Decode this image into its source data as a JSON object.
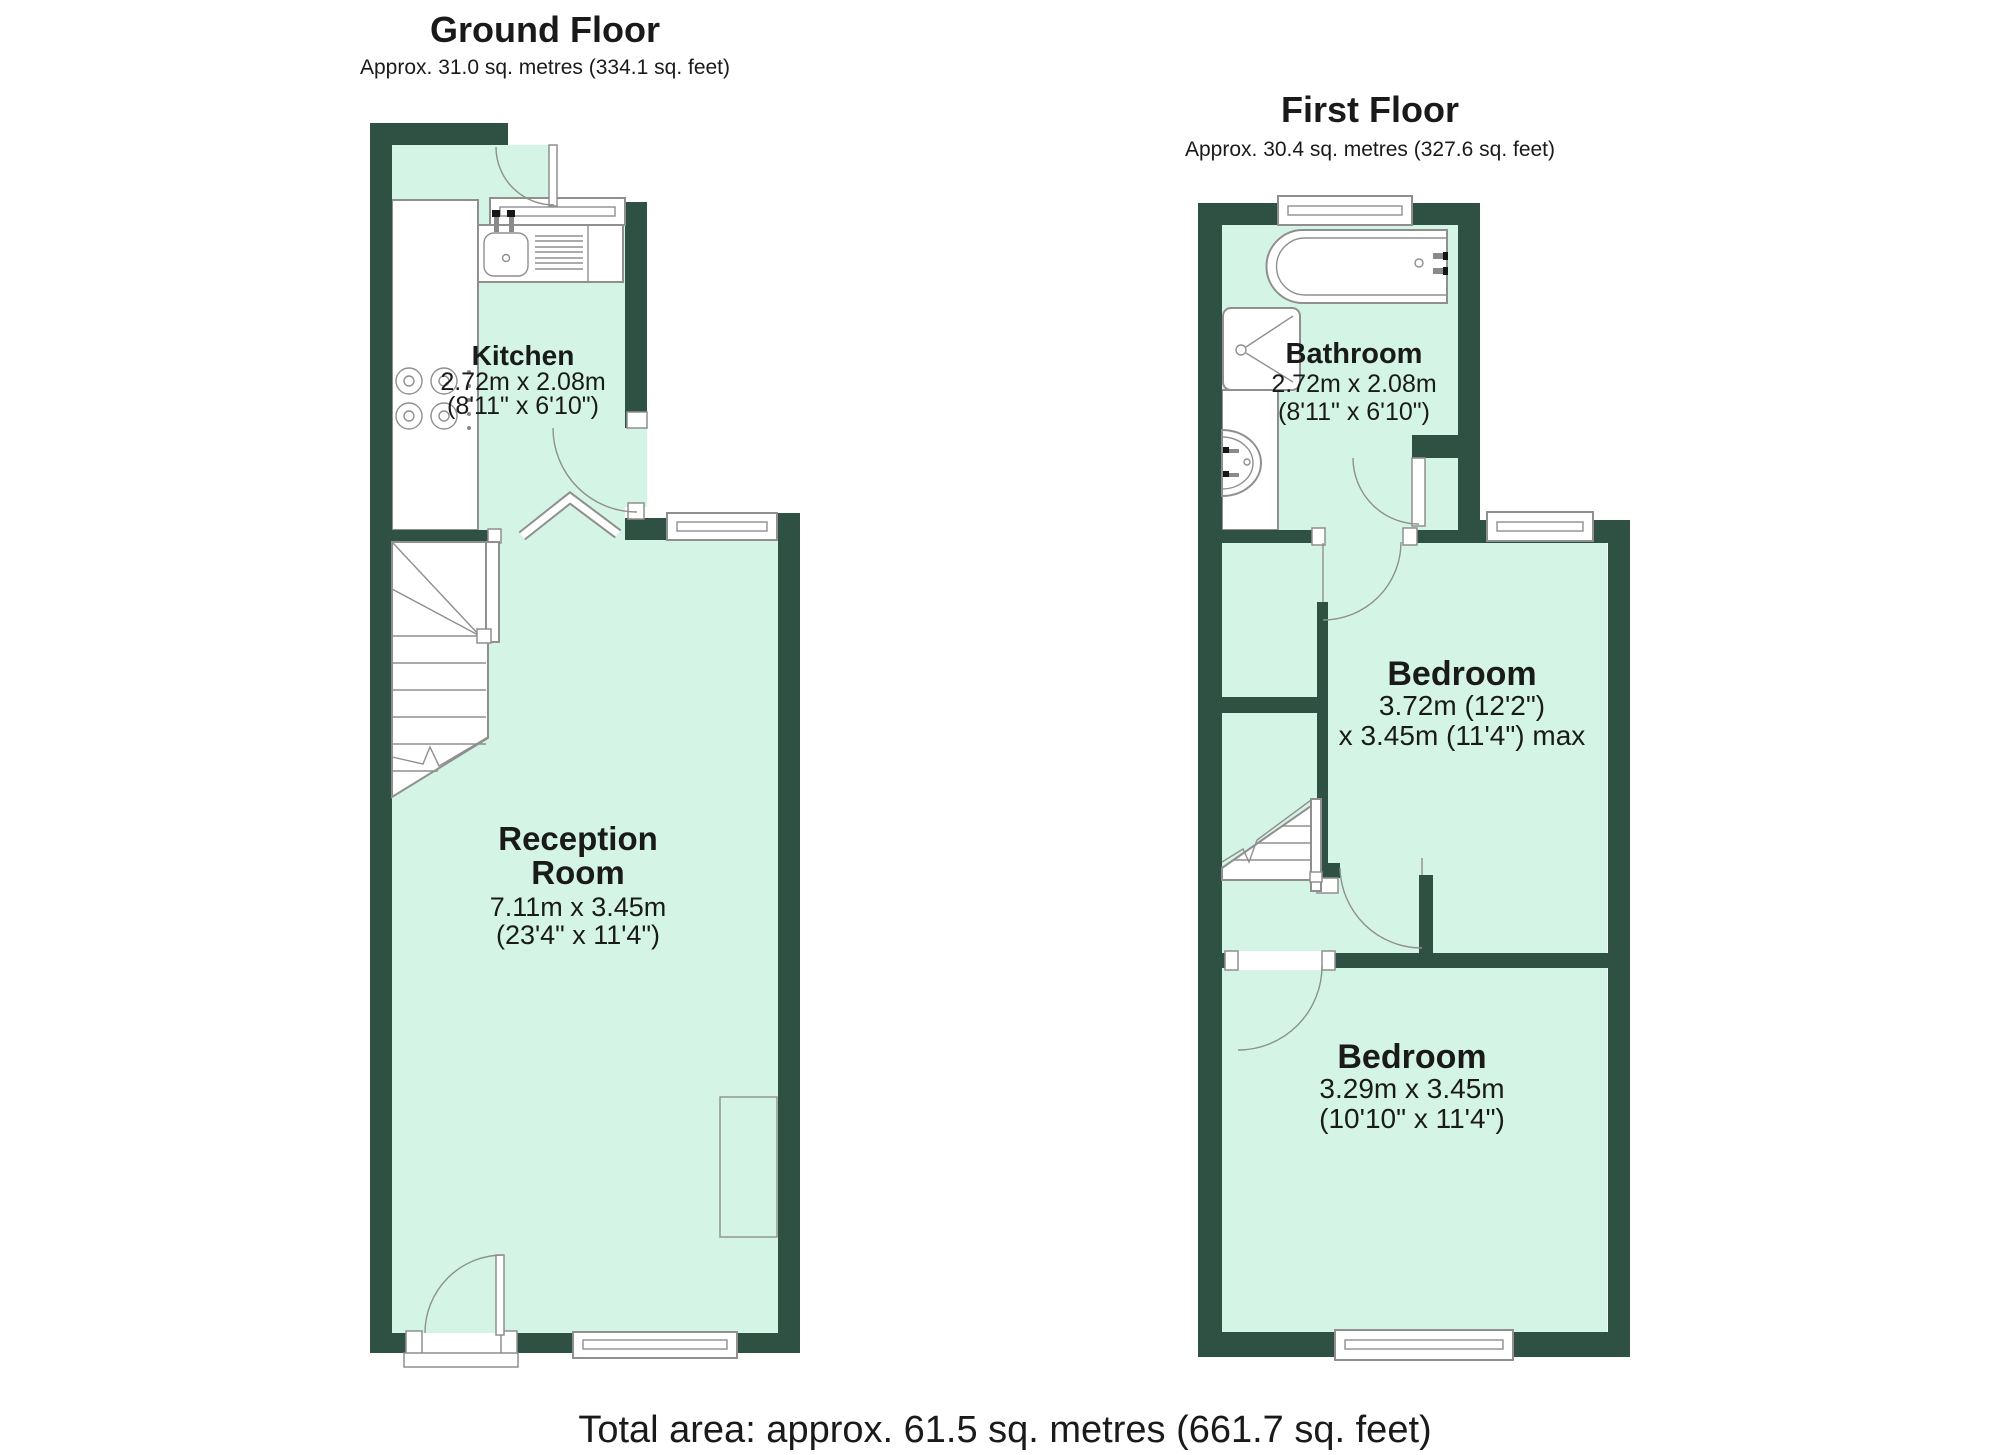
{
  "colors": {
    "wall": "#2e5144",
    "floor": "#d4f4e5",
    "outline": "#8f8f8f",
    "text": "#1a1a1a"
  },
  "ground_floor": {
    "title": "Ground Floor",
    "subtitle": "Approx. 31.0 sq. metres (334.1 sq. feet)",
    "rooms": {
      "kitchen": {
        "name": "Kitchen",
        "dim_metric": "2.72m x 2.08m",
        "dim_imperial": "(8'11\" x 6'10\")"
      },
      "reception": {
        "name_line1": "Reception",
        "name_line2": "Room",
        "dim_metric": "7.11m x 3.45m",
        "dim_imperial": "(23'4\" x 11'4\")"
      }
    }
  },
  "first_floor": {
    "title": "First Floor",
    "subtitle": "Approx. 30.4 sq. metres (327.6 sq. feet)",
    "rooms": {
      "bathroom": {
        "name": "Bathroom",
        "dim_metric": "2.72m x 2.08m",
        "dim_imperial": "(8'11\" x 6'10\")"
      },
      "bedroom_rear": {
        "name": "Bedroom",
        "dim_line1": "3.72m (12'2\")",
        "dim_line2": "x 3.45m (11'4\") max"
      },
      "bedroom_front": {
        "name": "Bedroom",
        "dim_metric": "3.29m x 3.45m",
        "dim_imperial": "(10'10\" x 11'4\")"
      }
    }
  },
  "footer": {
    "total_area": "Total area: approx. 61.5 sq. metres (661.7 sq. feet)"
  }
}
